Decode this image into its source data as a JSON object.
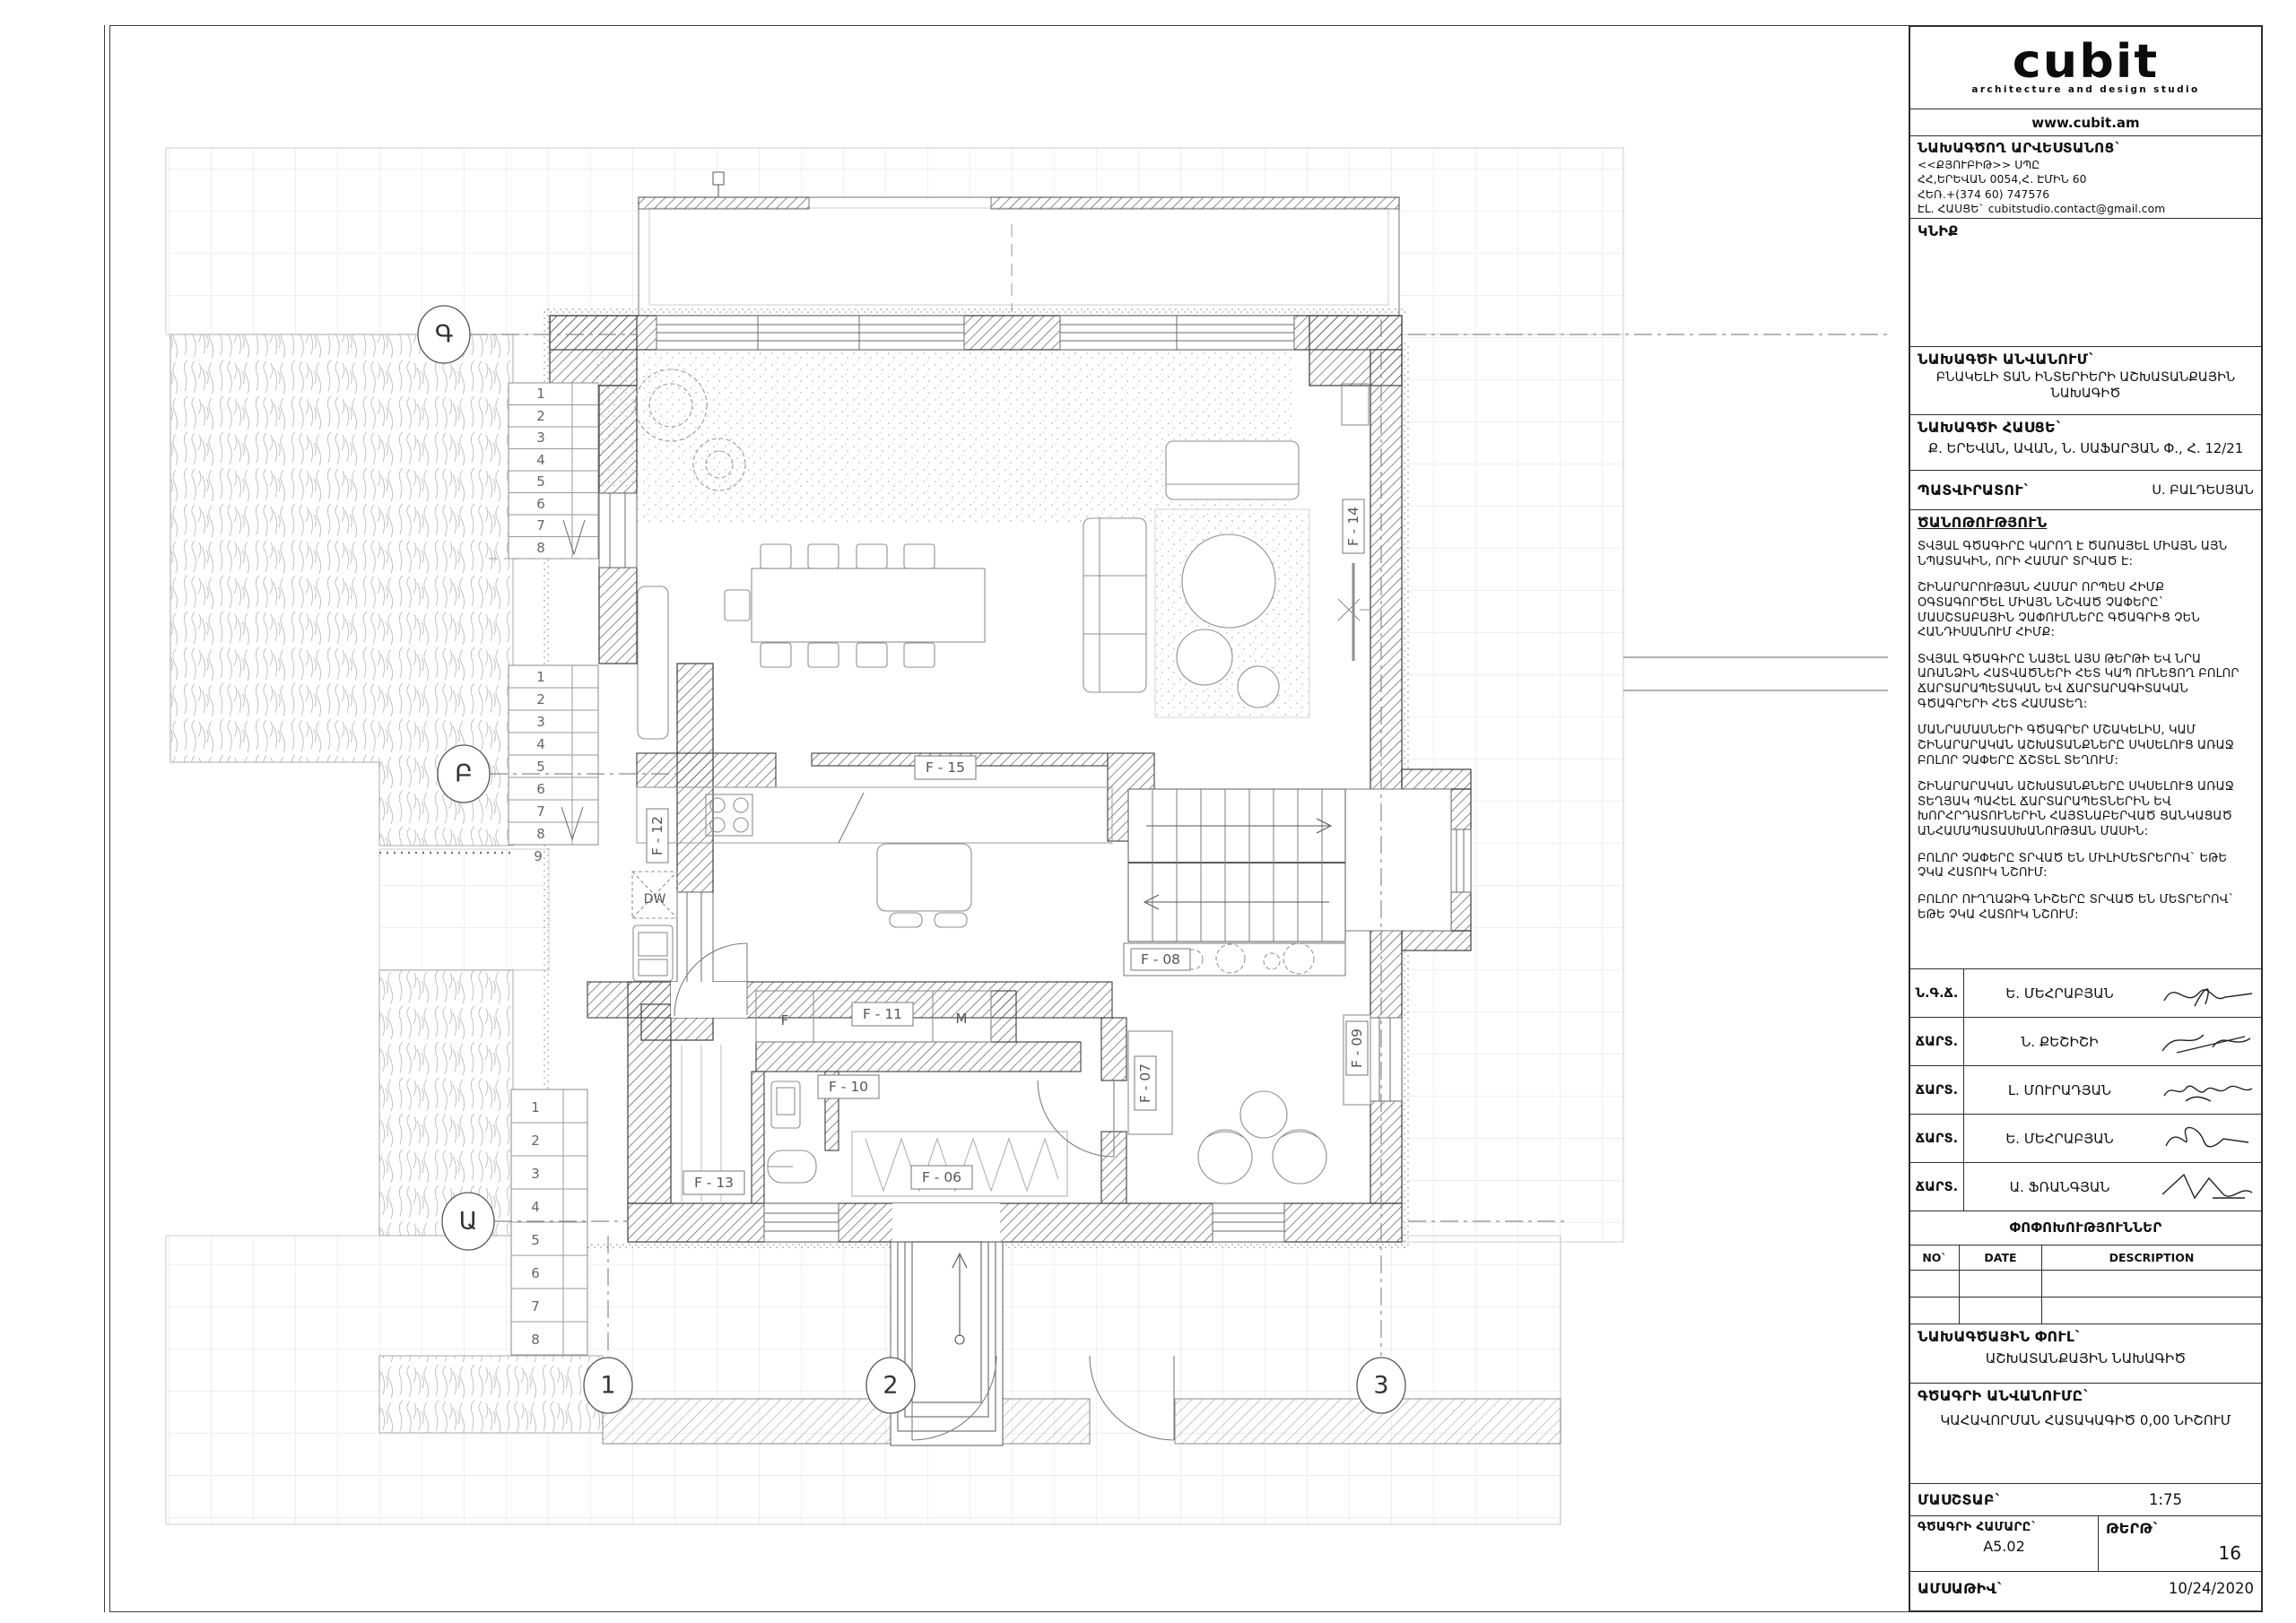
{
  "titleblock": {
    "logo": {
      "brand": "cubit",
      "subtitle": "architecture and design studio",
      "website": "www.cubit.am"
    },
    "studio": {
      "heading": "ՆԱԽԱԳԾՈՂ ԱՐՎԵՍՏԱՆՈՑ`",
      "lines": [
        "<<ՔՅՈՒԲԻԹ>> ՍՊԸ",
        "ՀՀ,ԵՐԵՎԱՆ 0054,Հ. ԷՄԻՆ 60",
        "ՀԵՌ.+(374 60) 747576",
        "ԷԼ. ՀԱՍՑԵ` cubitstudio.contact@gmail.com"
      ]
    },
    "seal_label": "ԿՆԻՔ",
    "project": {
      "name_label": "ՆԱԽԱԳԾԻ ԱՆՎԱՆՈՒՄ`",
      "name": "ԲՆԱԿԵԼԻ ՏԱՆ ԻՆՏԵՐԻԵՐԻ ԱՇԽԱՏԱՆՔԱՅԻՆ ՆԱԽԱԳԻԾ",
      "address_label": "ՆԱԽԱԳԾԻ ՀԱՍՑԵ`",
      "address": "Ք. ԵՐԵՎԱՆ, ԱՎԱՆ, Ն. ՍԱՖԱՐՅԱՆ Փ., Հ. 12/21",
      "client_label": "ՊԱՏՎԻՐԱՏՈՒ`",
      "client": "Ս. ԲԱԼԴԵՍՅԱՆ"
    },
    "notes": {
      "heading": "ԾԱՆՈԹՈՒԹՅՈՒՆ",
      "items": [
        "ՏՎՅԱԼ ԳԾԱԳԻՐԸ ԿԱՐՈՂ Է ԾԱՌԱՅԵԼ ՄԻԱՅՆ ԱՅՆ ՆՊԱՏԱԿԻՆ, ՈՐԻ ՀԱՄԱՐ ՏՐՎԱԾ Է:",
        "ՇԻՆԱՐԱՐՈՒԹՅԱՆ ՀԱՄԱՐ ՈՐՊԵՍ ՀԻՄՔ ՕԳՏԱԳՈՐԾԵԼ ՄԻԱՅՆ ՆՇՎԱԾ ՉԱՓԵՐԸ` ՄԱՍՇՏԱԲԱՅԻՆ ՉԱՓՈՒՄՆԵՐԸ ԳԾԱԳՐԻՑ ՉԵՆ ՀԱՆԴԻՍԱՆՈՒՄ ՀԻՄՔ:",
        "ՏՎՅԱԼ ԳԾԱԳԻՐԸ ՆԱՅԵԼ ԱՅՍ ԹԵՐԹԻ ԵՎ ՆՐԱ ԱՌԱՆՁԻՆ ՀԱՏՎԱԾՆԵՐԻ ՀԵՏ ԿԱՊ ՈՒՆԵՑՈՂ ԲՈԼՈՐ ՃԱՐՏԱՐԱՊԵՏԱԿԱՆ ԵՎ ՃԱՐՏԱՐԱԳԻՏԱԿԱՆ ԳԾԱԳՐԵՐԻ ՀԵՏ ՀԱՄԱՏԵՂ:",
        "ՄԱՆՐԱՄԱՍՆԵՐԻ ԳԾԱԳՐԵՐ ՄՇԱԿԵԼԻՍ, ԿԱՄ ՇԻՆԱՐԱՐԱԿԱՆ ԱՇԽԱՏԱՆՔՆԵՐԸ ՍԿՍԵԼՈՒՑ ԱՌԱՋ ԲՈԼՈՐ ՉԱՓԵՐԸ ՃՇՏԵԼ ՏԵՂՈՒՄ:",
        "ՇԻՆԱՐԱՐԱԿԱՆ ԱՇԽԱՏԱՆՔՆԵՐԸ ՍԿՍԵԼՈՒՑ ԱՌԱՋ ՏԵՂՅԱԿ ՊԱՀԵԼ ՃԱՐՏԱՐԱՊԵՏՆԵՐԻՆ ԵՎ ԽՈՐՀՐԴԱՏՈՒՆԵՐԻՆ ՀԱՅՏՆԱԲԵՐՎԱԾ ՑԱՆԿԱՑԱԾ ԱՆՀԱՄԱՊԱՏԱՍԽԱՆՈՒԹՅԱՆ ՄԱՍԻՆ:",
        "ԲՈԼՈՐ ՉԱՓԵՐԸ ՏՐՎԱԾ ԵՆ ՄԻԼԻՄԵՏՐԵՐՈՎ` ԵԹԵ ՉԿԱ ՀԱՏՈՒԿ ՆՇՈՒՄ:",
        "ԲՈԼՈՐ ՈՒՂՂԱՁԻԳ ՆԻՇԵՐԸ ՏՐՎԱԾ ԵՆ ՄԵՏՐԵՐՈՎ` ԵԹԵ ՉԿԱ ՀԱՏՈՒԿ ՆՇՈՒՄ:"
      ]
    },
    "signatures": {
      "rows": [
        {
          "role": "Ն.Գ.Ճ.",
          "name": "Ե. ՄԵՀՐԱԲՅԱՆ"
        },
        {
          "role": "ՃԱՐՏ.",
          "name": "Ն. ՔԵՇԻՇԻ"
        },
        {
          "role": "ՃԱՐՏ.",
          "name": "Լ. ՄՈՒՐԱԴՅԱՆ"
        },
        {
          "role": "ՃԱՐՏ.",
          "name": "Ե. ՄԵՀՐԱԲՅԱՆ"
        },
        {
          "role": "ՃԱՐՏ.",
          "name": "Ա. ՖՌԱՆԳՅԱՆ"
        }
      ]
    },
    "changes": {
      "heading": "ՓՈՓՈԽՈՒԹՅՈՒՆՆԵՐ",
      "no": "NO`",
      "date": "DATE",
      "description": "DESCRIPTION"
    },
    "phase": {
      "label": "ՆԱԽԱԳԾԱՅԻՆ ՓՈՒԼ`",
      "value": "ԱՇԽԱՏԱՆՔԱՅԻՆ ՆԱԽԱԳԻԾ"
    },
    "drawing": {
      "label": "ԳԾԱԳՐԻ ԱՆՎԱՆՈՒՄԸ`",
      "value": "ԿԱՀԱՎՈՐՄԱՆ ՀԱՏԱԿԱԳԻԾ 0,00 ՆԻՇՈՒՄ"
    },
    "scale": {
      "label": "ՄԱՍՇՏԱԲ`",
      "value": "1:75"
    },
    "number": {
      "label": "ԳԾԱԳՐԻ ՀԱՄԱՐԸ`",
      "value": "A5.02"
    },
    "sheet": {
      "label": "ԹԵՐԹ`",
      "value": "16"
    },
    "date": {
      "label": "ԱՄՍԱԹԻՎ`",
      "value": "10/24/2020"
    }
  },
  "plan": {
    "grid": {
      "row_labels": [
        "Գ",
        "Բ",
        "Ա"
      ],
      "col_labels": [
        "1",
        "2",
        "3"
      ]
    },
    "rooms": {
      "f06": "F - 06",
      "f07": "F - 07",
      "f08": "F - 08",
      "f09": "F - 09",
      "f10": "F - 10",
      "f11": "F - 11",
      "f12": "F - 12",
      "f13": "F - 13",
      "f14": "F - 14",
      "f15": "F - 15"
    },
    "marks": {
      "dishwasher": "DW",
      "washer": "F",
      "dryer": "M"
    },
    "stairs": {
      "upper_steps": [
        "1",
        "2",
        "3",
        "4",
        "5",
        "6",
        "7",
        "8"
      ],
      "middle_steps": [
        "1",
        "2",
        "3",
        "4",
        "5",
        "6",
        "7",
        "8"
      ],
      "middle_last": "9",
      "lower_steps": [
        "1",
        "2",
        "3",
        "4",
        "5",
        "6",
        "7",
        "8"
      ]
    }
  }
}
